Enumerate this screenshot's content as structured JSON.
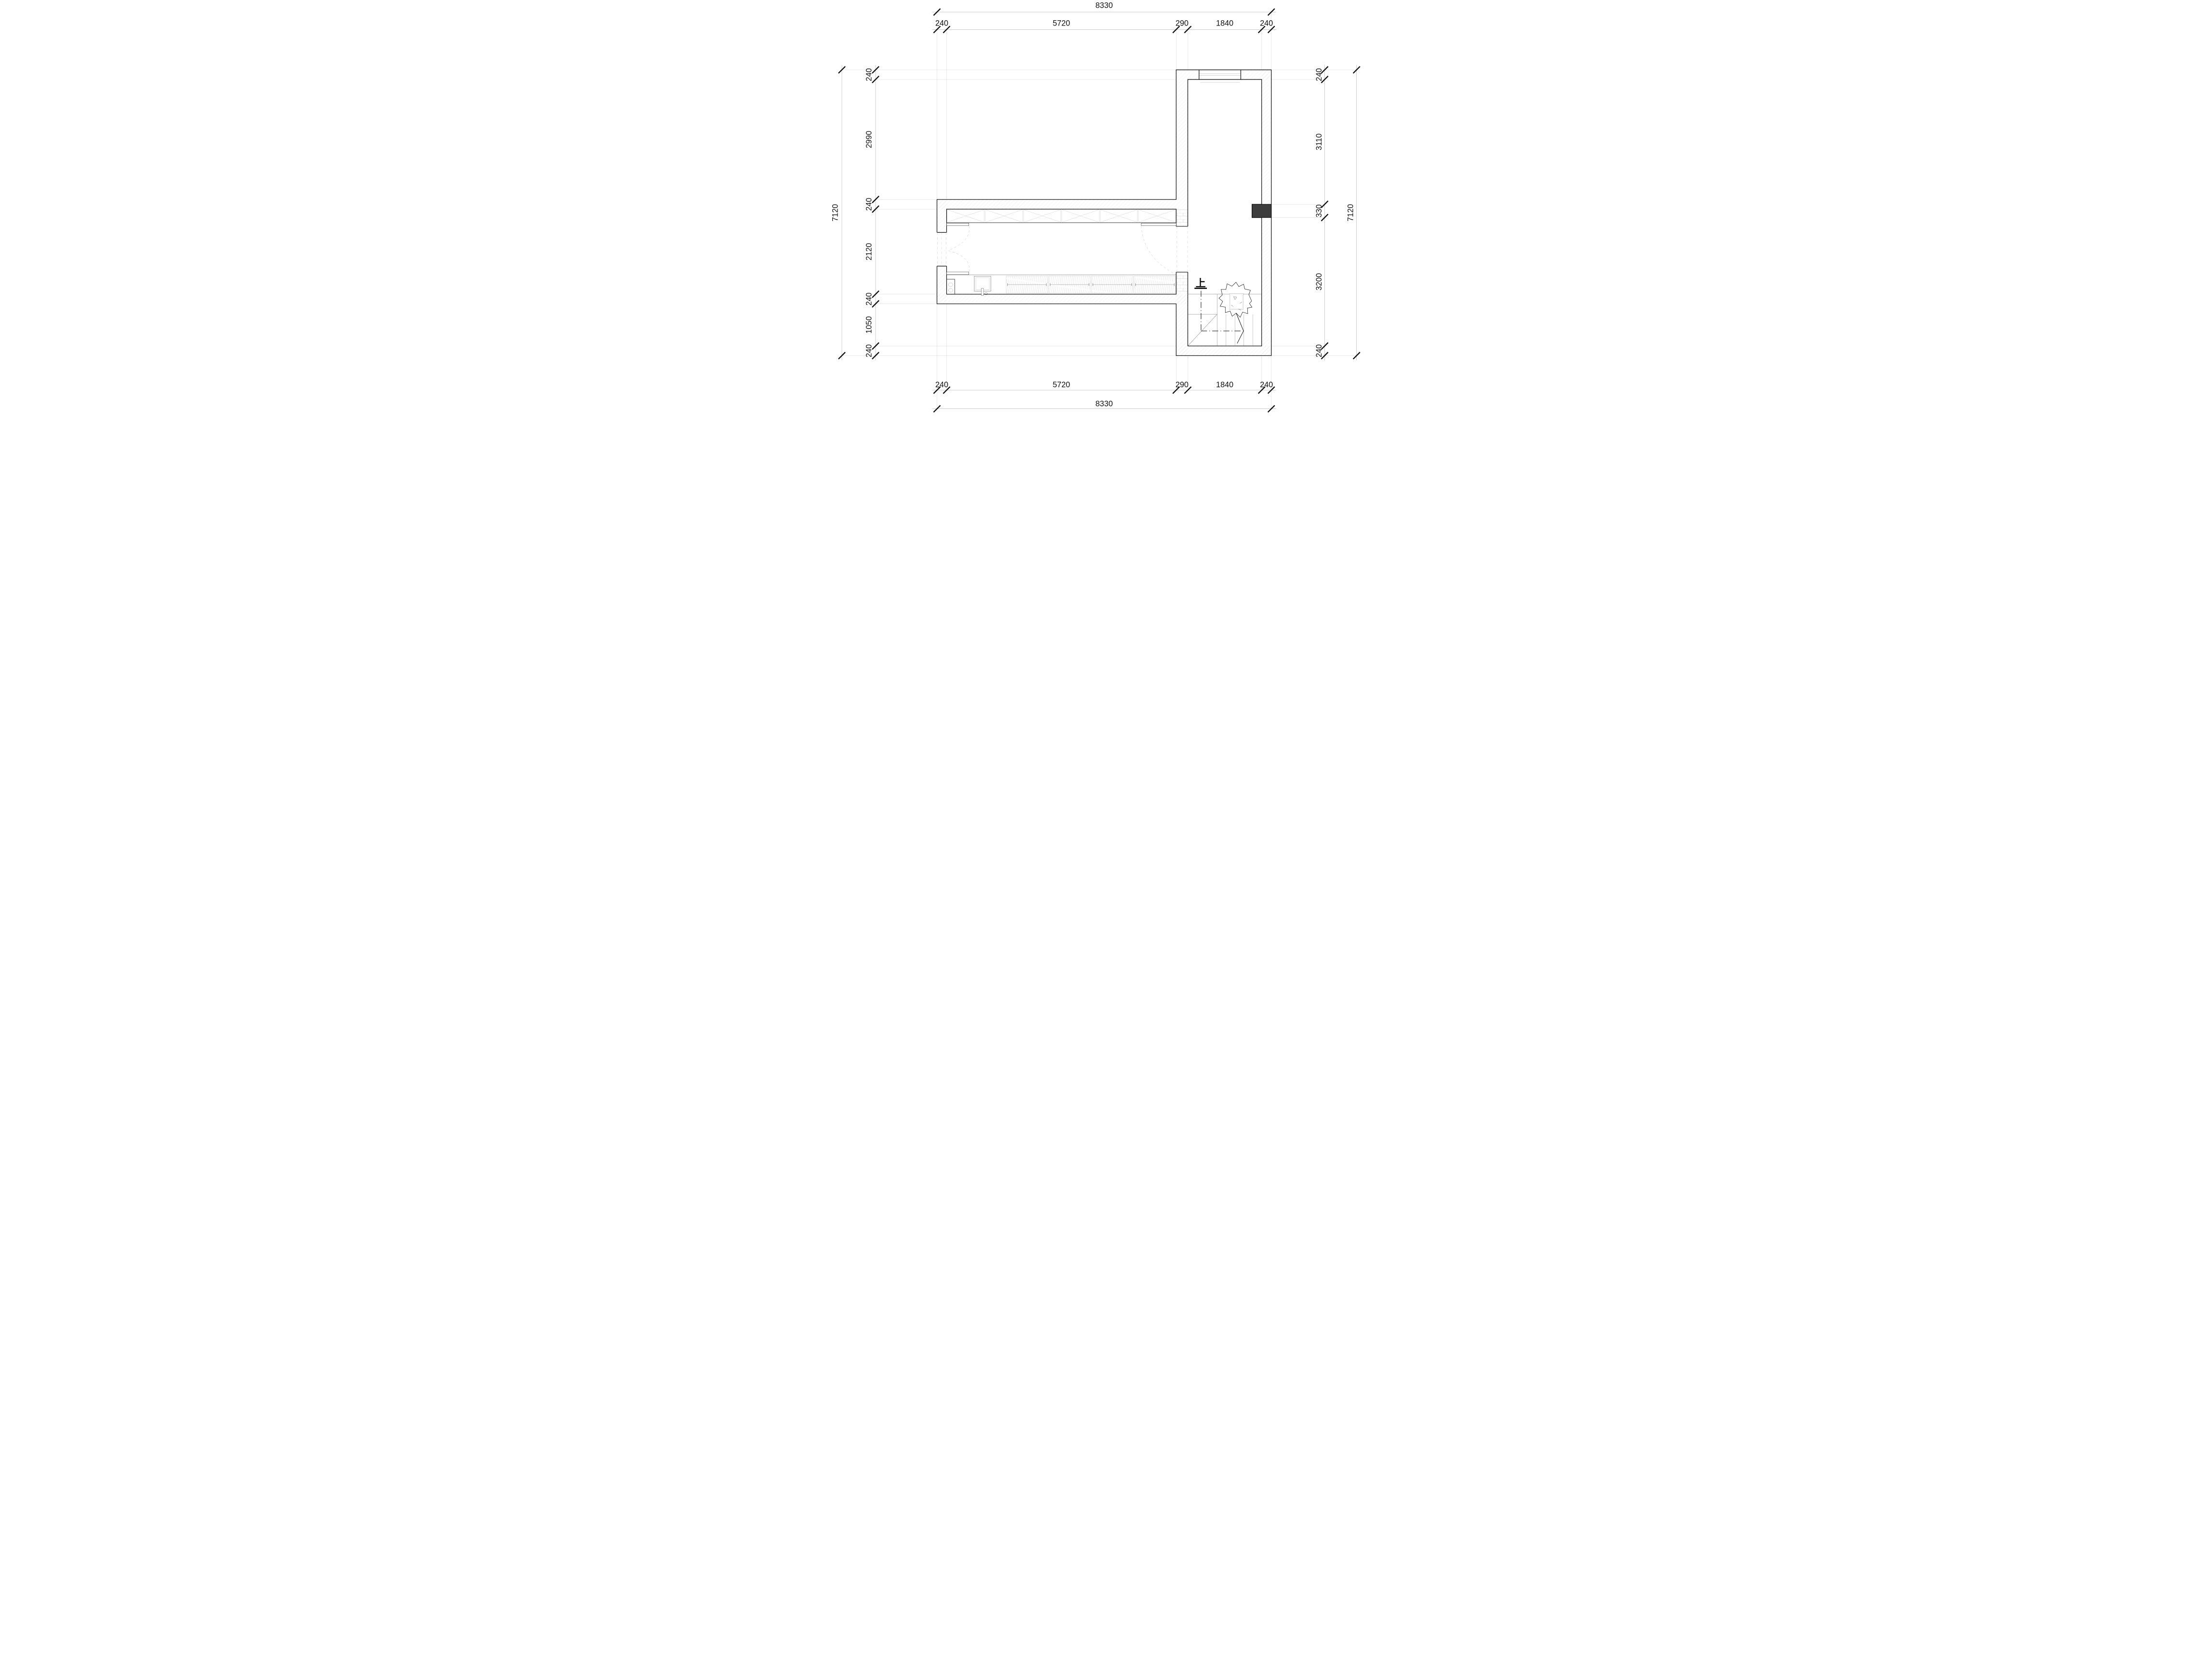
{
  "drawing": {
    "type": "architectural-floor-plan",
    "dims": {
      "top": {
        "total": "8330",
        "segs": [
          "240",
          "5720",
          "290",
          "1840",
          "240"
        ]
      },
      "bottom": {
        "total": "8330",
        "segs": [
          "240",
          "5720",
          "290",
          "1840",
          "240"
        ]
      },
      "left": {
        "total": "7120",
        "segs": [
          "240",
          "2990",
          "240",
          "2120",
          "240",
          "1050",
          "240"
        ]
      },
      "right": {
        "total": "7120",
        "segs": [
          "240",
          "3110",
          "330",
          "3200",
          "240"
        ]
      }
    },
    "stair": {
      "up_label": "上"
    },
    "colors": {
      "wall_outline": "#000000",
      "hatch_line": "#c6c6c6",
      "brick_line": "#aaaaaa",
      "dim_line": "#999999",
      "extension_line": "#bdbdbd",
      "text": "#111111",
      "column_fill": "#3d3d3d",
      "furniture_line": "#aaaaaa"
    }
  }
}
